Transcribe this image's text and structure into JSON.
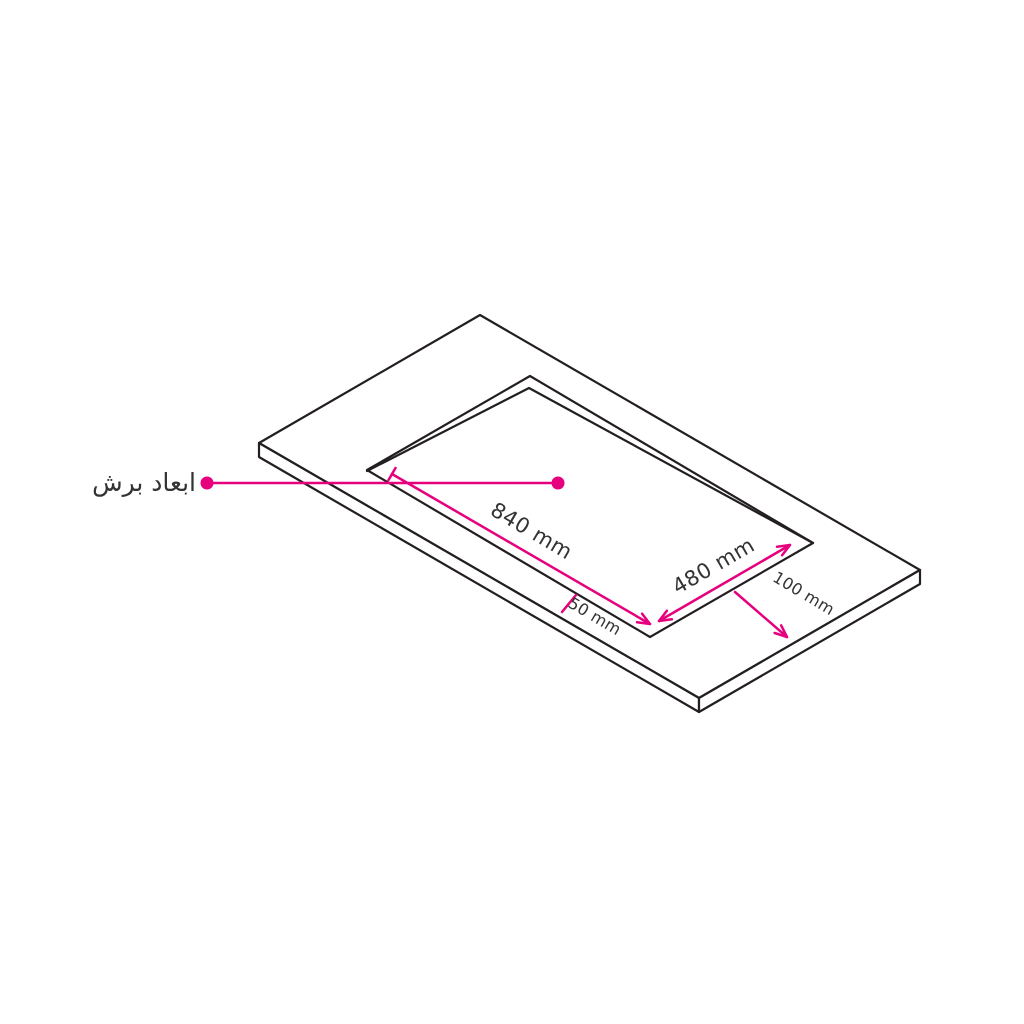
{
  "diagram": {
    "callout_label": "ابعاد برش",
    "dimensions": {
      "cutout_length": "840 mm",
      "cutout_width": "480 mm",
      "front_offset": "50 mm",
      "side_offset": "100 mm"
    },
    "colors": {
      "accent_magenta": "#e6007e",
      "outline_black": "#231f20",
      "label_text": "#333333",
      "background": "#ffffff"
    }
  }
}
